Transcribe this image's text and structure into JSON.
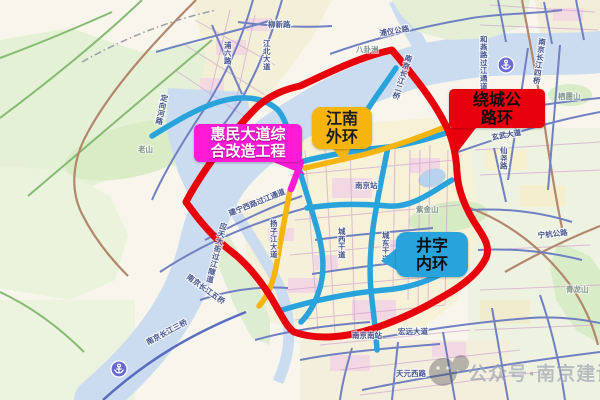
{
  "map": {
    "callouts": {
      "huimin": {
        "name": "惠民大道综合改造工程",
        "line1": "惠民大道综",
        "line2": "合改造工程",
        "color": "#ff1bd6",
        "text_color": "#ffffff"
      },
      "jiangnan_waihuan": {
        "name": "江南外环",
        "line1": "江南",
        "line2": "外环",
        "color": "#f6b40e",
        "text_color": "#1d1d1d"
      },
      "raocheng": {
        "name": "绕城公路环",
        "line1": "绕城公",
        "line2": "路环",
        "color": "#e8000d",
        "text_color": "#0e0e0e"
      },
      "jingzi_neihuan": {
        "name": "井字内环",
        "line1": "井字",
        "line2": "内环",
        "color": "#29a3dc",
        "text_color": "#0e0e0e"
      }
    },
    "route_colors": {
      "ring_expressway": "#e8000d",
      "jingzi_inner_ring": "#29a3dc",
      "jiangnan_outer_ring": "#f6b40e",
      "huimin_project_segment": "#ff1bd6"
    },
    "labels": [
      "柳新路",
      "浦六路",
      "江北大道",
      "定向河路",
      "老山",
      "浦仪公路",
      "八卦洲",
      "南京长江二桥",
      "和燕路过江通道",
      "南京长江四桥",
      "栖霞山",
      "玄武大道",
      "仙尧路",
      "宁杭公路",
      "青龙山",
      "紫金山",
      "南京站",
      "城西干道",
      "城东干道",
      "大街",
      "应天大街过江隧道",
      "扬子江大道",
      "建宁西路过江通道",
      "南京长江五桥",
      "南京长江三桥",
      "南京南站",
      "宏远大道",
      "天元西路"
    ],
    "watermark": {
      "text": "公众号·南京建设"
    }
  }
}
